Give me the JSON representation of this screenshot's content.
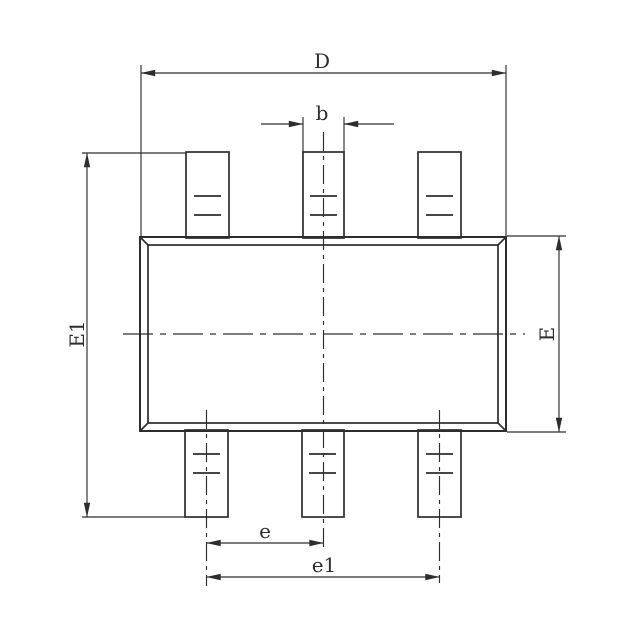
{
  "labels": {
    "D": "D",
    "b": "b",
    "E1": "E1",
    "E": "E",
    "e": "e",
    "e1": "e1"
  },
  "colors": {
    "line": "#2d2d2d",
    "background": "#ffffff"
  },
  "dimensions": [
    {
      "label": "D",
      "orientation": "horizontal",
      "position": "top",
      "spans": "package body width"
    },
    {
      "label": "b",
      "orientation": "horizontal",
      "position": "top",
      "spans": "lead width"
    },
    {
      "label": "E1",
      "orientation": "vertical",
      "position": "left",
      "spans": "overall height including leads"
    },
    {
      "label": "E",
      "orientation": "vertical",
      "position": "right",
      "spans": "body height"
    },
    {
      "label": "e",
      "orientation": "horizontal",
      "position": "bottom",
      "spans": "lead pitch"
    },
    {
      "label": "e1",
      "orientation": "horizontal",
      "position": "bottom",
      "spans": "outer lead span"
    }
  ]
}
